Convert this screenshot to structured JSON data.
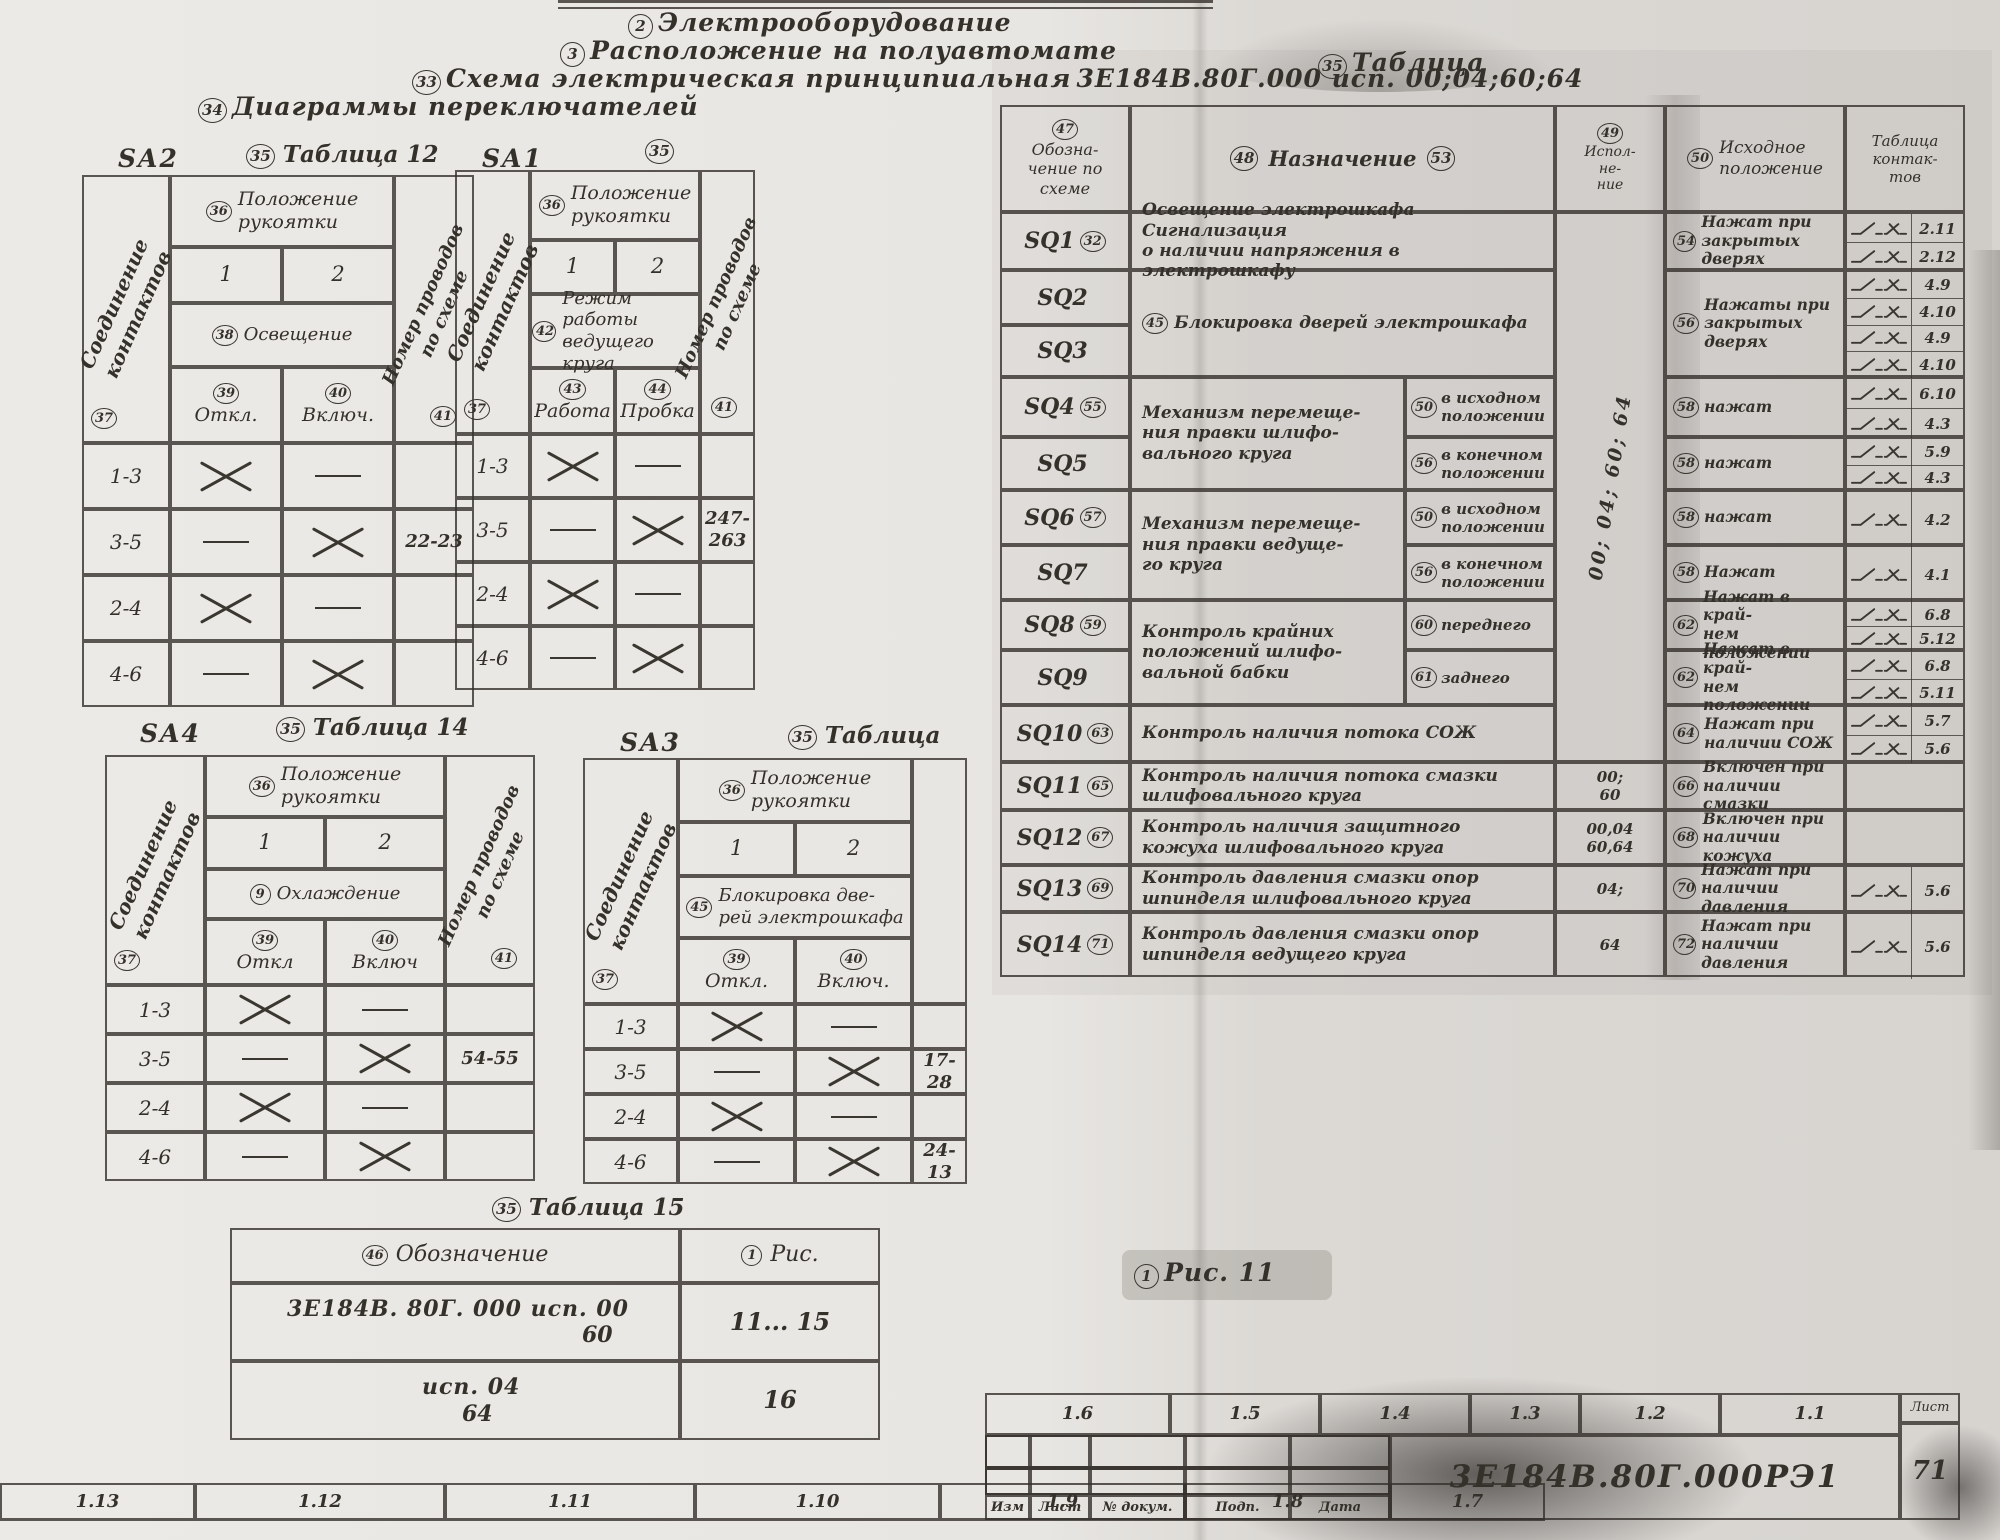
{
  "page": {
    "top_headers": [
      {
        "num": "2",
        "text": "Электрооборудование"
      },
      {
        "num": "3",
        "text": "Расположение на полуавтомате"
      },
      {
        "num": "33",
        "text": "Схема электрическая принципиальная",
        "doc": "3Е184В.80Г.000 исп. 00;04;60;64"
      }
    ],
    "diagrams_title": {
      "num": "34",
      "text": "Диаграммы переключателей"
    },
    "fig_caption": {
      "num": "1",
      "text": "Рис. 11"
    }
  },
  "switch_tables": [
    {
      "id": "SA2",
      "table_label": {
        "num": "35",
        "text": "Таблица 12"
      },
      "left_header": {
        "num": "37",
        "text": "Соединение\nконтактов"
      },
      "right_header": {
        "num": "41",
        "text": "Номер проводов\nпо схеме"
      },
      "pos_header": {
        "num": "36",
        "text": "Положение\nрукоятки"
      },
      "positions": [
        "1",
        "2"
      ],
      "mode": {
        "num": "38",
        "text": "Освещение"
      },
      "subs": [
        {
          "num": "39",
          "text": "Откл."
        },
        {
          "num": "40",
          "text": "Включ."
        }
      ],
      "rows": [
        {
          "c": "1-3",
          "p1": "x",
          "p2": "d",
          "w": ""
        },
        {
          "c": "3-5",
          "p1": "d",
          "p2": "x",
          "w": "22-23"
        },
        {
          "c": "2-4",
          "p1": "x",
          "p2": "d",
          "w": ""
        },
        {
          "c": "4-6",
          "p1": "d",
          "p2": "x",
          "w": ""
        }
      ]
    },
    {
      "id": "SA1",
      "table_label": {
        "num": "35",
        "text": ""
      },
      "left_header": {
        "num": "37",
        "text": "Соединение\nконтактов"
      },
      "right_header": {
        "num": "41",
        "text": "Номер проводов\nпо схеме"
      },
      "pos_header": {
        "num": "36",
        "text": "Положение\nрукоятки"
      },
      "positions": [
        "1",
        "2"
      ],
      "mode": {
        "num": "42",
        "text": "Режим работы\nведущего круга"
      },
      "subs": [
        {
          "num": "43",
          "text": "Работа"
        },
        {
          "num": "44",
          "text": "Пробка"
        }
      ],
      "rows": [
        {
          "c": "1-3",
          "p1": "x",
          "p2": "d",
          "w": ""
        },
        {
          "c": "3-5",
          "p1": "d",
          "p2": "x",
          "w": "247-\n263"
        },
        {
          "c": "2-4",
          "p1": "x",
          "p2": "d",
          "w": ""
        },
        {
          "c": "4-6",
          "p1": "d",
          "p2": "x",
          "w": ""
        }
      ]
    },
    {
      "id": "SA4",
      "table_label": {
        "num": "35",
        "text": "Таблица 14"
      },
      "left_header": {
        "num": "37",
        "text": "Соединение\nконтактов"
      },
      "right_header": {
        "num": "41",
        "text": "Номер проводов\nпо схеме"
      },
      "pos_header": {
        "num": "36",
        "text": "Положение\nрукоятки"
      },
      "positions": [
        "1",
        "2"
      ],
      "mode": {
        "num": "9",
        "text": "Охлаждение"
      },
      "subs": [
        {
          "num": "39",
          "text": "Откл"
        },
        {
          "num": "40",
          "text": "Включ"
        }
      ],
      "rows": [
        {
          "c": "1-3",
          "p1": "x",
          "p2": "d",
          "w": ""
        },
        {
          "c": "3-5",
          "p1": "d",
          "p2": "x",
          "w": "54-55"
        },
        {
          "c": "2-4",
          "p1": "x",
          "p2": "d",
          "w": ""
        },
        {
          "c": "4-6",
          "p1": "d",
          "p2": "x",
          "w": ""
        }
      ]
    },
    {
      "id": "SA3",
      "table_label": {
        "num": "35",
        "text": "Таблица"
      },
      "left_header": {
        "num": "37",
        "text": "Соединение\nконтактов"
      },
      "right_header": null,
      "pos_header": {
        "num": "36",
        "text": "Положение\nрукоятки"
      },
      "positions": [
        "1",
        "2"
      ],
      "mode": {
        "num": "45",
        "text": "Блокировка две-\nрей электрошкафа"
      },
      "subs": [
        {
          "num": "39",
          "text": "Откл."
        },
        {
          "num": "40",
          "text": "Включ."
        }
      ],
      "rows": [
        {
          "c": "1-3",
          "p1": "x",
          "p2": "d",
          "w": ""
        },
        {
          "c": "3-5",
          "p1": "d",
          "p2": "x",
          "w": "17-\n28"
        },
        {
          "c": "2-4",
          "p1": "x",
          "p2": "d",
          "w": ""
        },
        {
          "c": "4-6",
          "p1": "d",
          "p2": "x",
          "w": "24-\n13"
        }
      ]
    }
  ],
  "table15": {
    "label": {
      "num": "35",
      "text": "Таблица 15"
    },
    "col_designation": {
      "num": "46",
      "text": "Обозначение"
    },
    "col_fig": {
      "num": "1",
      "text": "Рис."
    },
    "rows": [
      {
        "line1": "3Е184В. 80Г. 000   исп.  00",
        "line2": "60",
        "fig": "11... 15"
      },
      {
        "line1": "исп.  04",
        "line2": "64",
        "fig": "16"
      }
    ]
  },
  "main_table": {
    "table_label": {
      "num": "35",
      "text": "Таблица"
    },
    "col_designation": {
      "num": "47",
      "text": "Обозна-\nчение по\nсхеме"
    },
    "col_purpose": {
      "num": "48",
      "text": "Назначение",
      "num_after": "53"
    },
    "col_version": {
      "num": "49",
      "text": "Испол-\nне-\nние"
    },
    "col_initial": {
      "num": "50",
      "text": "Исходное\nположение"
    },
    "col_contacts": {
      "text": "Таблица\nконтак-\nтов"
    },
    "version_span": "00; 04; 60; 64",
    "rows": [
      {
        "id": "SQ1",
        "idnum": "32",
        "desc": {
          "rows": 1,
          "cols": 2,
          "text": "Освещение электрошкафа Сигнализация\nо наличии напряжения в электрошкафу"
        },
        "init": {
          "num": "54",
          "text": "Нажат при\nзакрытых дверях"
        },
        "contacts": [
          "2.11",
          "2.12"
        ]
      },
      {
        "id": "SQ2",
        "desc": {
          "rows": 2,
          "cols": 2,
          "num": "45",
          "text": "Блокировка дверей  электрошкафа"
        },
        "init": {
          "num": "56",
          "rows": 2,
          "text": "Нажаты при\nзакрытых\nдверях"
        },
        "contactrows": 2,
        "contacts": [
          "4.9",
          "4.10",
          "4.9",
          "4.10"
        ]
      },
      {
        "id": "SQ3"
      },
      {
        "id": "SQ4",
        "idnum": "55",
        "desc": {
          "rows": 2,
          "cols": 1,
          "text": "Механизм перемеще-\nния правки шлифо-\nвального круга"
        },
        "pos": {
          "num": "50",
          "text": "в исходном\nположении"
        },
        "init": {
          "num": "58",
          "text": "нажат"
        },
        "contacts": [
          "6.10",
          "4.3"
        ]
      },
      {
        "id": "SQ5",
        "pos": {
          "num": "56",
          "text": "в конечном\nположении"
        },
        "init": {
          "num": "58",
          "text": "нажат"
        },
        "contacts": [
          "5.9",
          "4.3"
        ]
      },
      {
        "id": "SQ6",
        "idnum": "57",
        "desc": {
          "rows": 2,
          "cols": 1,
          "text": "Механизм перемеще-\nния правки ведуще-\nго круга"
        },
        "pos": {
          "num": "50",
          "text": "в исходном\nположении"
        },
        "init": {
          "num": "58",
          "text": "нажат"
        },
        "contacts": [
          "4.2"
        ]
      },
      {
        "id": "SQ7",
        "pos": {
          "num": "56",
          "text": "в конечном\nположении"
        },
        "init": {
          "num": "58",
          "text": "Нажат"
        },
        "contacts": [
          "4.1"
        ]
      },
      {
        "id": "SQ8",
        "idnum": "59",
        "desc": {
          "rows": 2,
          "cols": 1,
          "text": "Контроль крайних\nположений шлифо-\nвальной бабки"
        },
        "pos": {
          "num": "60",
          "text": "переднего"
        },
        "init": {
          "num": "62",
          "text": "Нажат в край-\nнем положении"
        },
        "contacts": [
          "6.8",
          "5.12"
        ]
      },
      {
        "id": "SQ9",
        "pos": {
          "num": "61",
          "text": "заднего"
        },
        "init": {
          "num": "62",
          "text": "Нажат в край-\nнем положении"
        },
        "contacts": [
          "6.8",
          "5.11"
        ]
      },
      {
        "id": "SQ10",
        "idnum": "63",
        "desc": {
          "rows": 1,
          "cols": 2,
          "text": "Контроль наличия потока СОЖ"
        },
        "init": {
          "num": "64",
          "text": "Нажат при\nналичии СОЖ"
        },
        "contacts": [
          "5.7",
          "5.6"
        ]
      },
      {
        "id": "SQ11",
        "idnum": "65",
        "desc": {
          "rows": 1,
          "cols": 2,
          "text": "Контроль наличия потока смазки\nшлифовального круга"
        },
        "ver": "00;\n60",
        "init": {
          "num": "66",
          "text": "Включен при\nналичии смазки"
        },
        "contacts": []
      },
      {
        "id": "SQ12",
        "idnum": "67",
        "desc": {
          "rows": 1,
          "cols": 2,
          "text": "Контроль наличия защитного\nкожуха шлифовального круга"
        },
        "ver": "00,04\n60,64",
        "init": {
          "num": "68",
          "text": "Включен при\nналичии кожуха"
        },
        "contacts": []
      },
      {
        "id": "SQ13",
        "idnum": "69",
        "desc": {
          "rows": 1,
          "cols": 2,
          "text": "Контроль давления смазки  опор\nшпинделя шлифовального круга"
        },
        "ver": "04;",
        "init": {
          "num": "70",
          "text": "Нажат при\nналичии давления"
        },
        "contacts": [
          "5.6"
        ]
      },
      {
        "id": "SQ14",
        "idnum": "71",
        "desc": {
          "rows": 1,
          "cols": 2,
          "text": "Контроль давления смазки  опор\nшпинделя ведущего круга"
        },
        "ver": "64",
        "init": {
          "num": "72",
          "text": "Нажат при\nналичии давления"
        },
        "contacts": [
          "5.6"
        ]
      }
    ]
  },
  "footer": {
    "left_cells": [
      "1.13",
      "1.12",
      "1.11",
      "1.10",
      "1.9",
      "1.8",
      "1.7"
    ],
    "title_block": {
      "top_cells": [
        "1.6",
        "1.5",
        "1.4",
        "1.3",
        "1.2",
        "1.1"
      ],
      "doc_number": "3Е184В.80Г.000РЭ1",
      "sheet_label": "Лист",
      "sheet_number": "71",
      "bottom_labels": [
        "Изм",
        "Лист",
        "№ докум.",
        "Подп.",
        "Дата"
      ]
    }
  }
}
